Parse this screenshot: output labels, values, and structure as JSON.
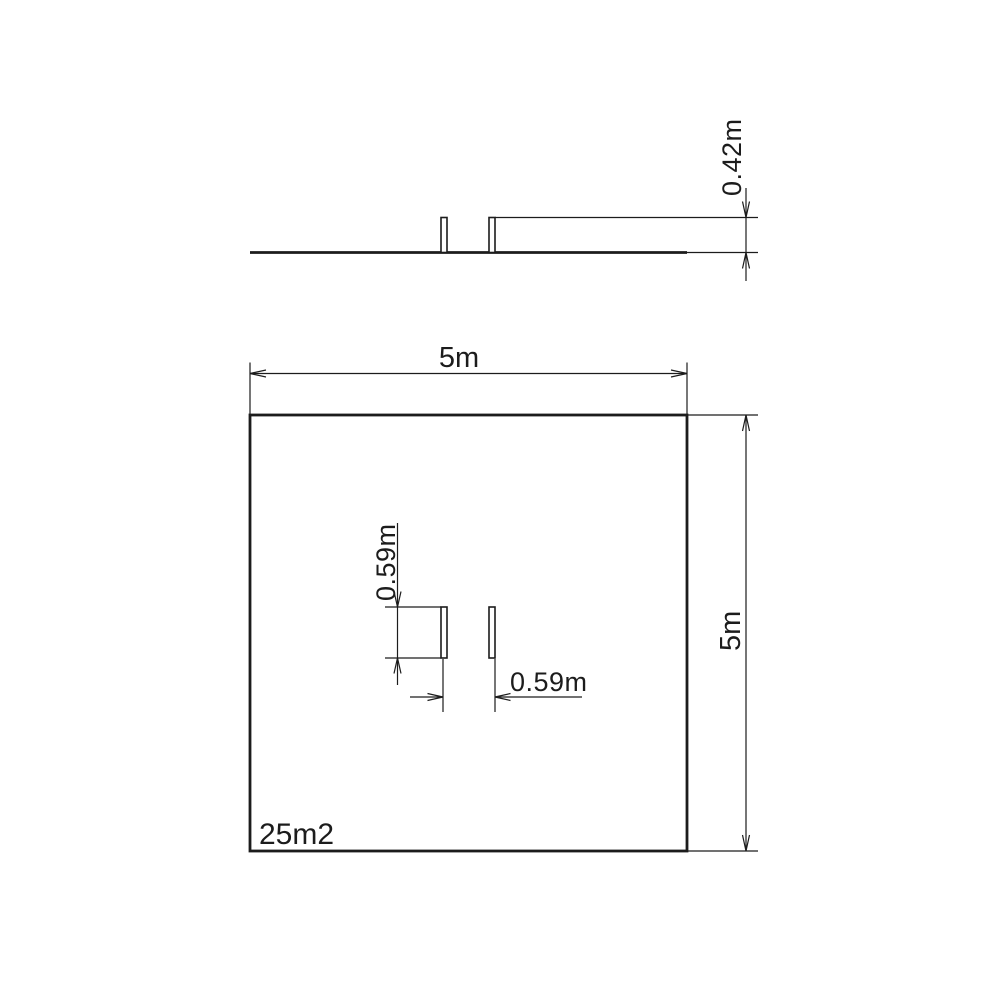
{
  "colors": {
    "ink": "#1c1c1c"
  },
  "drawing": {
    "elevation_view": {
      "thickness_dim_label": "0.42m"
    },
    "plan_view": {
      "width_dim_label": "5m",
      "height_dim_label": "5m",
      "area_label": "25m2",
      "opening_depth_dim_label": "0.59m",
      "opening_width_dim_label": "0.59m"
    }
  }
}
